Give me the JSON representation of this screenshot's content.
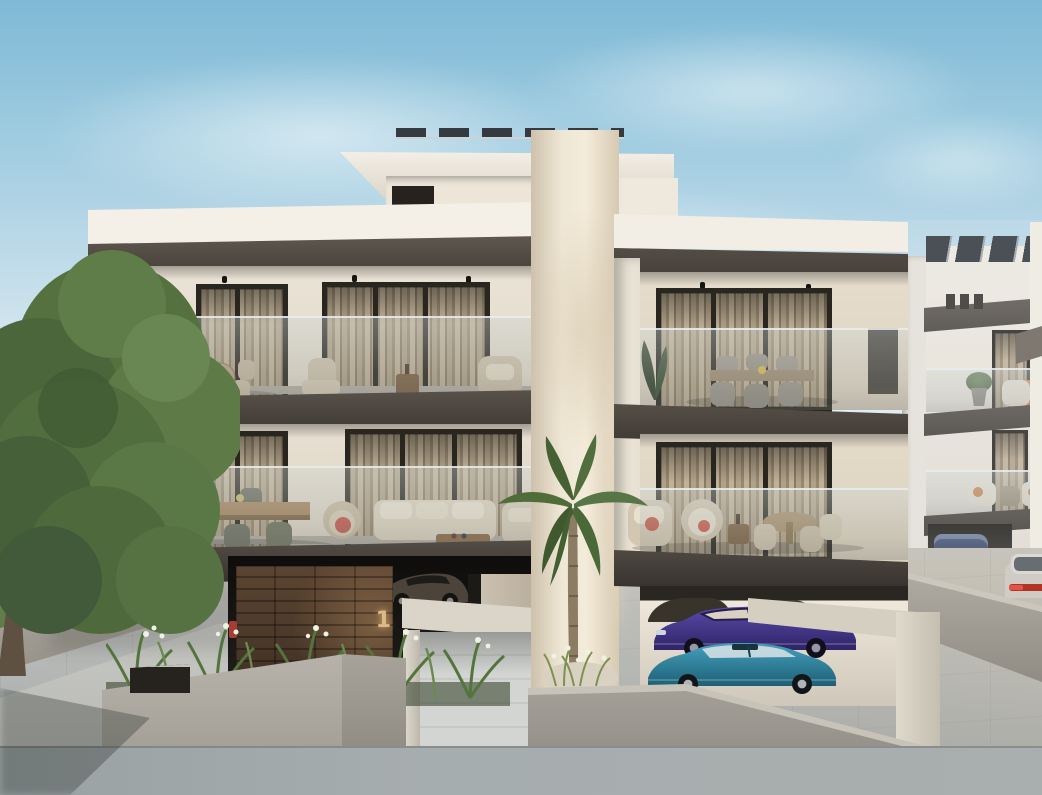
{
  "scene": {
    "type": "3D architectural rendering",
    "description": "Modern two-storey apartment building with glass-railed balconies, covered ground-level parking, central sculpted column with palm tree, landscaped planters, neighbouring building at right",
    "signage": {
      "unit_number": "1"
    },
    "palette": {
      "sky_top": "#7fb9d6",
      "sky_horizon": "#e6eef3",
      "cloud": "#ffffff",
      "facade_white": "#efe8dc",
      "facade_shade": "#dcd3c4",
      "parapet": "#f4f0e7",
      "fascia_dark": "#554e47",
      "slab_dark": "#3a3530",
      "column_cream": "#efe7d5",
      "glass_tint": "#b9c0bf",
      "door_frame": "#29251f",
      "curtain": "#a5977f",
      "wood_wall": "#4a3425",
      "unit_number_gold": "#dcb98b",
      "red_fixture": "#a63c34",
      "car_dark": "#4c443a",
      "car_purple": "#47398f",
      "car_teal": "#2f7e9b",
      "car_white": "#d3d0ca",
      "car_blue": "#3e5070",
      "tree_foliage": "#55713f",
      "lawn": "#6f8c55",
      "palm_frond": "#4f6c3a",
      "planter_plants": "#5a7a44",
      "flower_white": "#eef2e4",
      "concrete": "#aaa69e",
      "pavement": "#b6bab9",
      "sidewalk": "#a3aaac",
      "solar_panel": "#2e3339"
    },
    "elements": {
      "sky": "clear blue sky with soft clouds",
      "left_tree": "large green deciduous tree and lawn behind low concrete wall",
      "penthouse": "rooftop volume with overhanging white slab and flat solar panels",
      "central_column": "tall cream sculpted column splitting the two wings",
      "palm_tree": "slender palm in front of the central column",
      "left_wing_upper_balcony": "round dining table with beige chairs, lounge chair, side table, armchair, potted plant",
      "left_wing_lower_balcony": "rectangular dining table with olive chairs, rattan armchair with red cushion, white sofa set, wooden coffee table, banana plant",
      "right_wing_upper_balcony": "rectangular dining table with six grey wicker chairs, dark barbecue unit",
      "right_wing_lower_balcony": "rattan lounge chair with red pillow, papasan chair, wooden side table, round dining table with beige chairs",
      "ground_parking_left": "dark sports car inside garage behind timber feature wall numbered 1",
      "ground_parking_right": "purple sedan and teal fastback parked under building, dark cars behind",
      "planter": "concrete planter with ferns and white flowers",
      "entrance": "white portal frame with tiled driveway into garage",
      "neighbour_building": "white building with grey fascias, rooftop solar panels, balcony furniture with orange cushions, garage with blue car, white car on driveway",
      "foreground": "large-format tiled driveway and sidewalk with concrete retaining walls"
    }
  }
}
